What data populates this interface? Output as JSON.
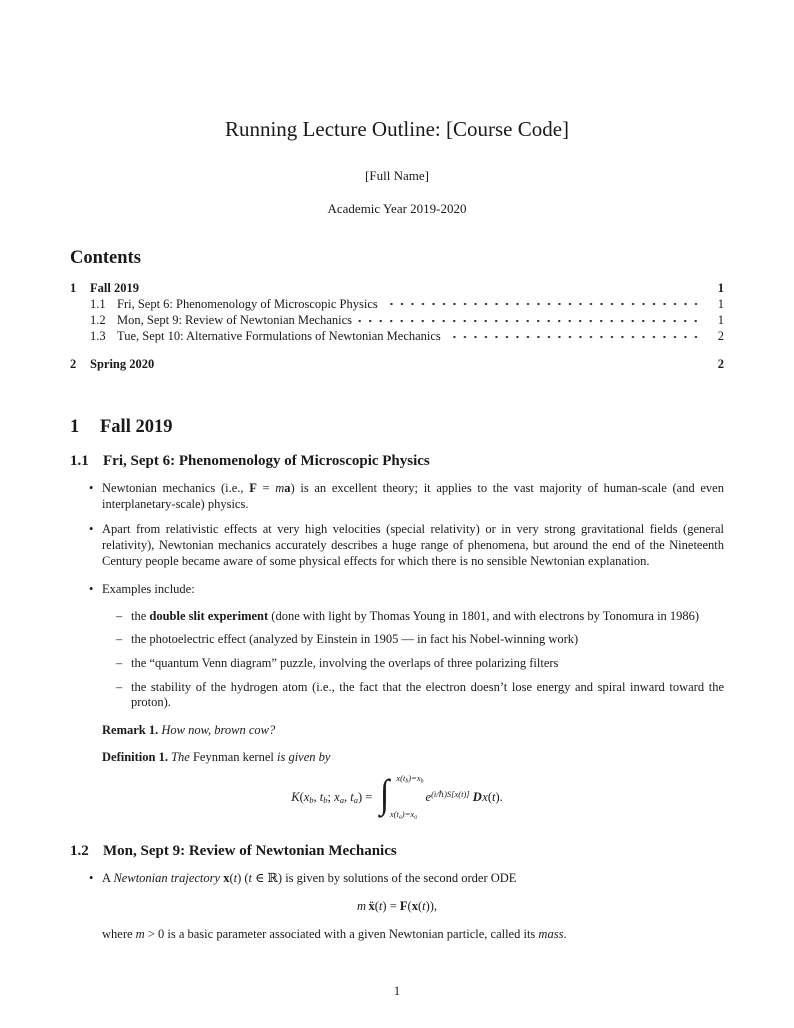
{
  "doc": {
    "title": "Running Lecture Outline: [Course Code]",
    "author": "[Full Name]",
    "date": "Academic Year 2019-2020",
    "footer_page_number": "1"
  },
  "markers": {
    "bullet": "•",
    "dash": "–"
  },
  "contents": {
    "heading": "Contents",
    "entries": [
      {
        "num": "1",
        "label": "Fall 2019",
        "page": "1"
      },
      {
        "num": "1.1",
        "label": "Fri, Sept 6: Phenomenology of Microscopic Physics",
        "page": "1"
      },
      {
        "num": "1.2",
        "label": "Mon, Sept 9: Review of Newtonian Mechanics",
        "page": "1"
      },
      {
        "num": "1.3",
        "label": "Tue, Sept 10: Alternative Formulations of Newtonian Mechanics",
        "page": "2"
      },
      {
        "num": "2",
        "label": "Spring 2020",
        "page": "2"
      }
    ]
  },
  "section1": {
    "num": "1",
    "title": "Fall 2019"
  },
  "sec11": {
    "num": "1.1",
    "title": "Fri, Sept 6: Phenomenology of Microscopic Physics",
    "bullet1": [
      {
        "t": "Newtonian mechanics (i.e., "
      },
      {
        "t": "F",
        "s": "mbf"
      },
      {
        "t": " = "
      },
      {
        "t": "m",
        "s": "i"
      },
      {
        "t": "a",
        "s": "mbf"
      },
      {
        "t": ") is an excellent theory; it applies to the vast majority of human-scale (and even interplanetary-scale) physics."
      }
    ],
    "bullet2": [
      {
        "t": "Apart from relativistic effects at very high velocities (special relativity) or in very strong gravitational fields (general relativity), Newtonian mechanics accurately describes a huge range of phenomena, but around the end of the Nineteenth Century people became aware of some physical effects for which there is no sensible Newtonian explanation."
      }
    ],
    "bullet3": [
      {
        "t": "Examples include:"
      }
    ],
    "sub1": [
      {
        "t": "the "
      },
      {
        "t": "double slit experiment",
        "s": "b"
      },
      {
        "t": " (done with light by Thomas Young in 1801, and with electrons by Tonomura in 1986)"
      }
    ],
    "sub2": [
      {
        "t": "the photoelectric effect (analyzed by Einstein in 1905 — in fact his Nobel-winning work)"
      }
    ],
    "sub3": [
      {
        "t": "the “quantum Venn diagram” puzzle, involving the overlaps of three polarizing filters"
      }
    ],
    "sub4": [
      {
        "t": "the stability of the hydrogen atom (i.e., the fact that the electron doesn’t lose energy and spiral inward toward the proton)."
      }
    ],
    "remark": {
      "label": "Remark 1.",
      "body": [
        {
          "t": " How now, brown cow?",
          "s": "i"
        }
      ]
    },
    "definition": {
      "label": "Definition 1.",
      "body": [
        {
          "t": " The ",
          "s": "i"
        },
        {
          "t": "Feynman kernel"
        },
        {
          "t": " is given by",
          "s": "i"
        }
      ]
    },
    "equation": {
      "lhs": [
        {
          "t": "K",
          "s": "i"
        },
        {
          "t": "("
        },
        {
          "t": "x",
          "s": "i"
        },
        {
          "t": "b",
          "s": "sub"
        },
        {
          "t": ", "
        },
        {
          "t": "t",
          "s": "i"
        },
        {
          "t": "b",
          "s": "sub"
        },
        {
          "t": "; "
        },
        {
          "t": "x",
          "s": "i"
        },
        {
          "t": "a",
          "s": "sub"
        },
        {
          "t": ", "
        },
        {
          "t": "t",
          "s": "i"
        },
        {
          "t": "a",
          "s": "sub"
        },
        {
          "t": ") = "
        }
      ],
      "integral_sign": "∫",
      "upper": [
        {
          "t": "x"
        },
        {
          "t": "("
        },
        {
          "t": "t"
        },
        {
          "t": "b",
          "s": "sub"
        },
        {
          "t": ")="
        },
        {
          "t": "x"
        },
        {
          "t": "b",
          "s": "sub"
        }
      ],
      "lower": [
        {
          "t": "x"
        },
        {
          "t": "("
        },
        {
          "t": "t"
        },
        {
          "t": "a",
          "s": "sub"
        },
        {
          "t": ")="
        },
        {
          "t": "x"
        },
        {
          "t": "a",
          "s": "sub"
        }
      ],
      "rhs": [
        {
          "t": "e",
          "s": "i"
        },
        {
          "t": "(i/ℏ)S[x(t)]",
          "s": "sup"
        },
        {
          "t": " "
        },
        {
          "t": "D",
          "s": "scr"
        },
        {
          "t": "x",
          "s": "i"
        },
        {
          "t": "("
        },
        {
          "t": "t",
          "s": "i"
        },
        {
          "t": ")."
        }
      ]
    }
  },
  "sec12": {
    "num": "1.2",
    "title": "Mon, Sept 9: Review of Newtonian Mechanics",
    "bullet1": [
      {
        "t": "A "
      },
      {
        "t": "Newtonian trajectory",
        "s": "i"
      },
      {
        "t": " "
      },
      {
        "t": "x",
        "s": "mbf"
      },
      {
        "t": "("
      },
      {
        "t": "t",
        "s": "i"
      },
      {
        "t": ") ("
      },
      {
        "t": "t",
        "s": "i"
      },
      {
        "t": " ∈ ℝ) is given by solutions of the second order ODE"
      }
    ],
    "equation": [
      {
        "t": "m",
        "s": "i"
      },
      {
        "t": " "
      },
      {
        "t": "ẍ",
        "s": "mbf"
      },
      {
        "t": "("
      },
      {
        "t": "t",
        "s": "i"
      },
      {
        "t": ") = "
      },
      {
        "t": "F",
        "s": "mbf"
      },
      {
        "t": "("
      },
      {
        "t": "x",
        "s": "mbf"
      },
      {
        "t": "("
      },
      {
        "t": "t",
        "s": "i"
      },
      {
        "t": ")),"
      }
    ],
    "after": [
      {
        "t": "where "
      },
      {
        "t": "m",
        "s": "i"
      },
      {
        "t": " > 0 is a basic parameter associated with a given Newtonian particle, called its "
      },
      {
        "t": "mass",
        "s": "i"
      },
      {
        "t": "."
      }
    ]
  }
}
